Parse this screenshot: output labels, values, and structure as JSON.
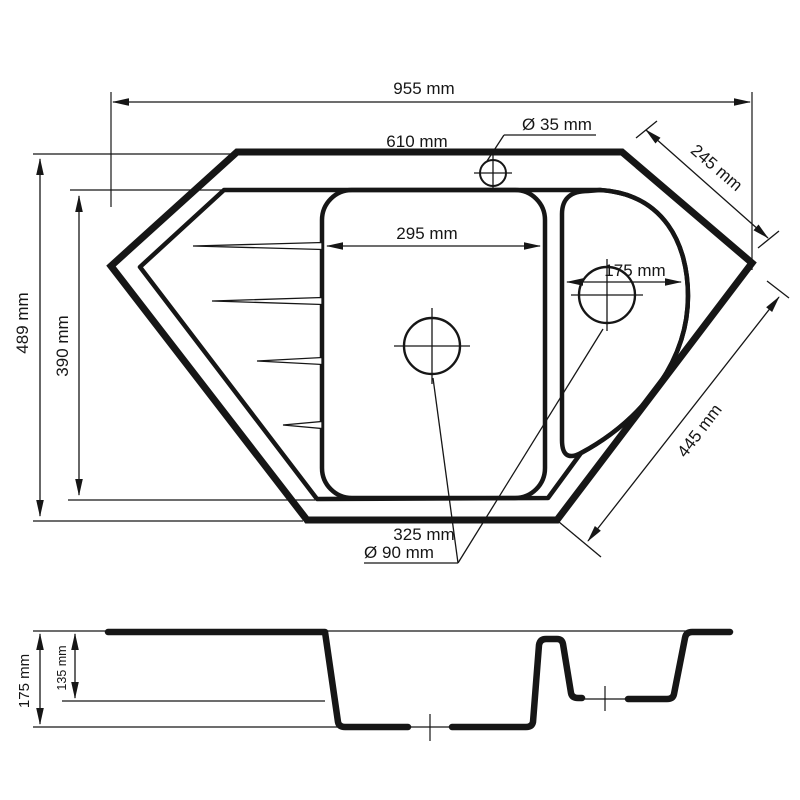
{
  "drawing": {
    "type": "sink-technical-drawing",
    "views": [
      "top-plan-view",
      "side-section-view"
    ],
    "line_color": "#161616",
    "background": "#ffffff"
  },
  "dims": {
    "overall_width": "955 mm",
    "top_edge": "610 mm",
    "faucet_hole": "Ø 35 mm",
    "upper_right_chamfer": "245 mm",
    "main_bowl_width": "295 mm",
    "small_bowl_width": "175 mm",
    "overall_depth": "489 mm",
    "inner_depth": "390 mm",
    "lower_right_chamfer": "445 mm",
    "bottom_edge": "325 mm",
    "drain_diameter": "Ø 90 mm",
    "total_height": "175 mm",
    "small_bowl_depth": "135 mm"
  }
}
